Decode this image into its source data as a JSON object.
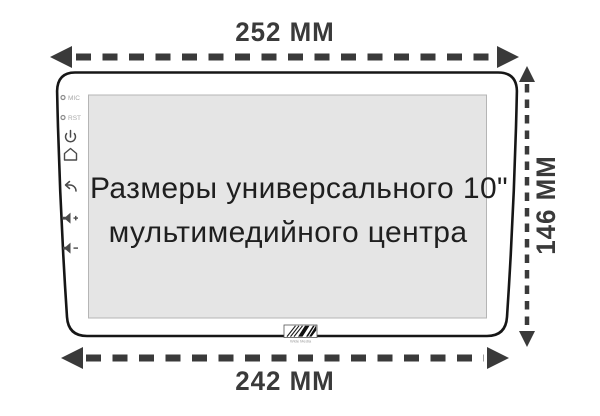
{
  "diagram": {
    "title_line1": "Размеры универсального 10\"",
    "title_line2": "мультимедийного центра",
    "dimensions": {
      "width_top": "252 ММ",
      "height_right": "146 ММ",
      "width_bottom": "242 ММ"
    },
    "bezel": {
      "mic_label": "MIC",
      "rst_label": "RST"
    },
    "logo_text": "Wide Media",
    "colors": {
      "dimension": "#3a3a3a",
      "outline": "#161616",
      "screen_bg": "#e5e5e5",
      "background": "#ffffff"
    }
  }
}
